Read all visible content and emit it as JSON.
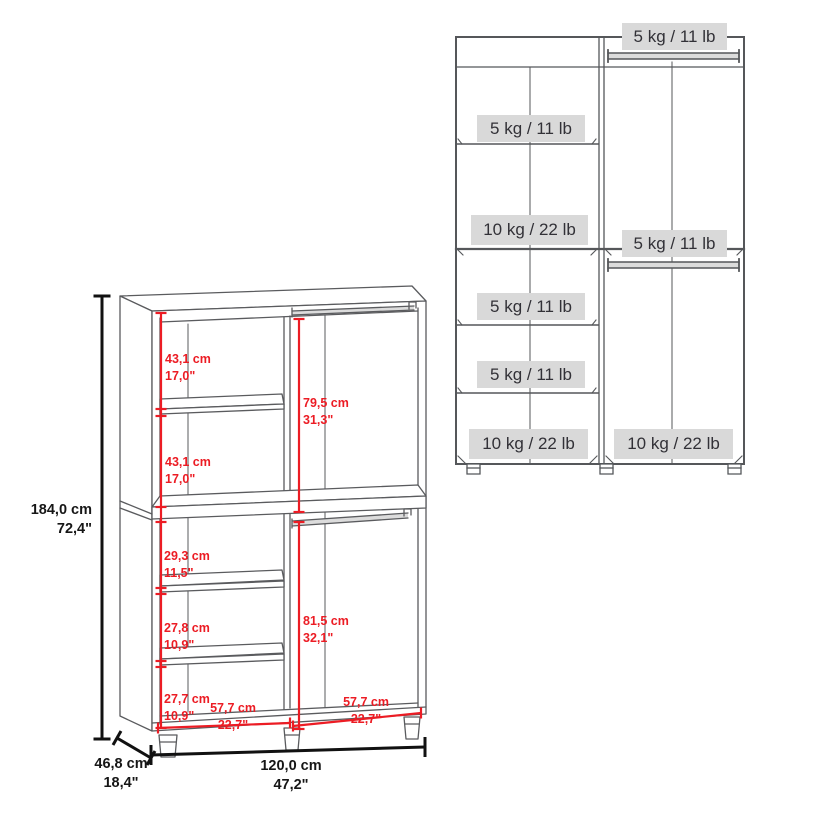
{
  "left_diagram": {
    "description": "wardrobe perspective drawing with dimensions",
    "overall": {
      "height_cm": "184,0 cm",
      "height_in": "72,4\"",
      "width_cm": "120,0 cm",
      "width_in": "47,2\"",
      "depth_cm": "46,8 cm",
      "depth_in": "18,4\""
    },
    "sections": {
      "top_left_upper": {
        "cm": "43,1 cm",
        "in": "17,0\""
      },
      "top_left_lower": {
        "cm": "43,1 cm",
        "in": "17,0\""
      },
      "top_right_hang": {
        "cm": "79,5 cm",
        "in": "31,3\""
      },
      "bottom_left_1": {
        "cm": "29,3 cm",
        "in": "11,5\""
      },
      "bottom_left_2": {
        "cm": "27,8 cm",
        "in": "10,9\""
      },
      "bottom_left_3": {
        "cm": "27,7 cm",
        "in": "10,9\""
      },
      "bottom_right_hang": {
        "cm": "81,5 cm",
        "in": "32,1\""
      },
      "bottom_left_width": {
        "cm": "57,7 cm",
        "in": "22,7\""
      },
      "bottom_right_width": {
        "cm": "57,7 cm",
        "in": "22,7\""
      }
    }
  },
  "right_diagram": {
    "description": "wardrobe front view with load capacities",
    "labels": [
      {
        "text": "5 kg / 11 lb",
        "position": "right-column-top-rod"
      },
      {
        "text": "5 kg / 11 lb",
        "position": "left-column-shelf-1"
      },
      {
        "text": "10 kg / 22 lb",
        "position": "left-column-mid-divider"
      },
      {
        "text": "5 kg / 11 lb",
        "position": "right-column-mid-rod"
      },
      {
        "text": "5 kg / 11 lb",
        "position": "left-column-shelf-2"
      },
      {
        "text": "5 kg / 11 lb",
        "position": "left-column-shelf-3"
      },
      {
        "text": "10 kg / 22 lb",
        "position": "left-column-bottom"
      },
      {
        "text": "10 kg / 22 lb",
        "position": "right-column-bottom"
      }
    ]
  },
  "colors": {
    "dimension_red": "#ec1c24",
    "line_gray": "#58595b",
    "label_bg": "#d9d9d9",
    "dimension_black": "#111111"
  }
}
